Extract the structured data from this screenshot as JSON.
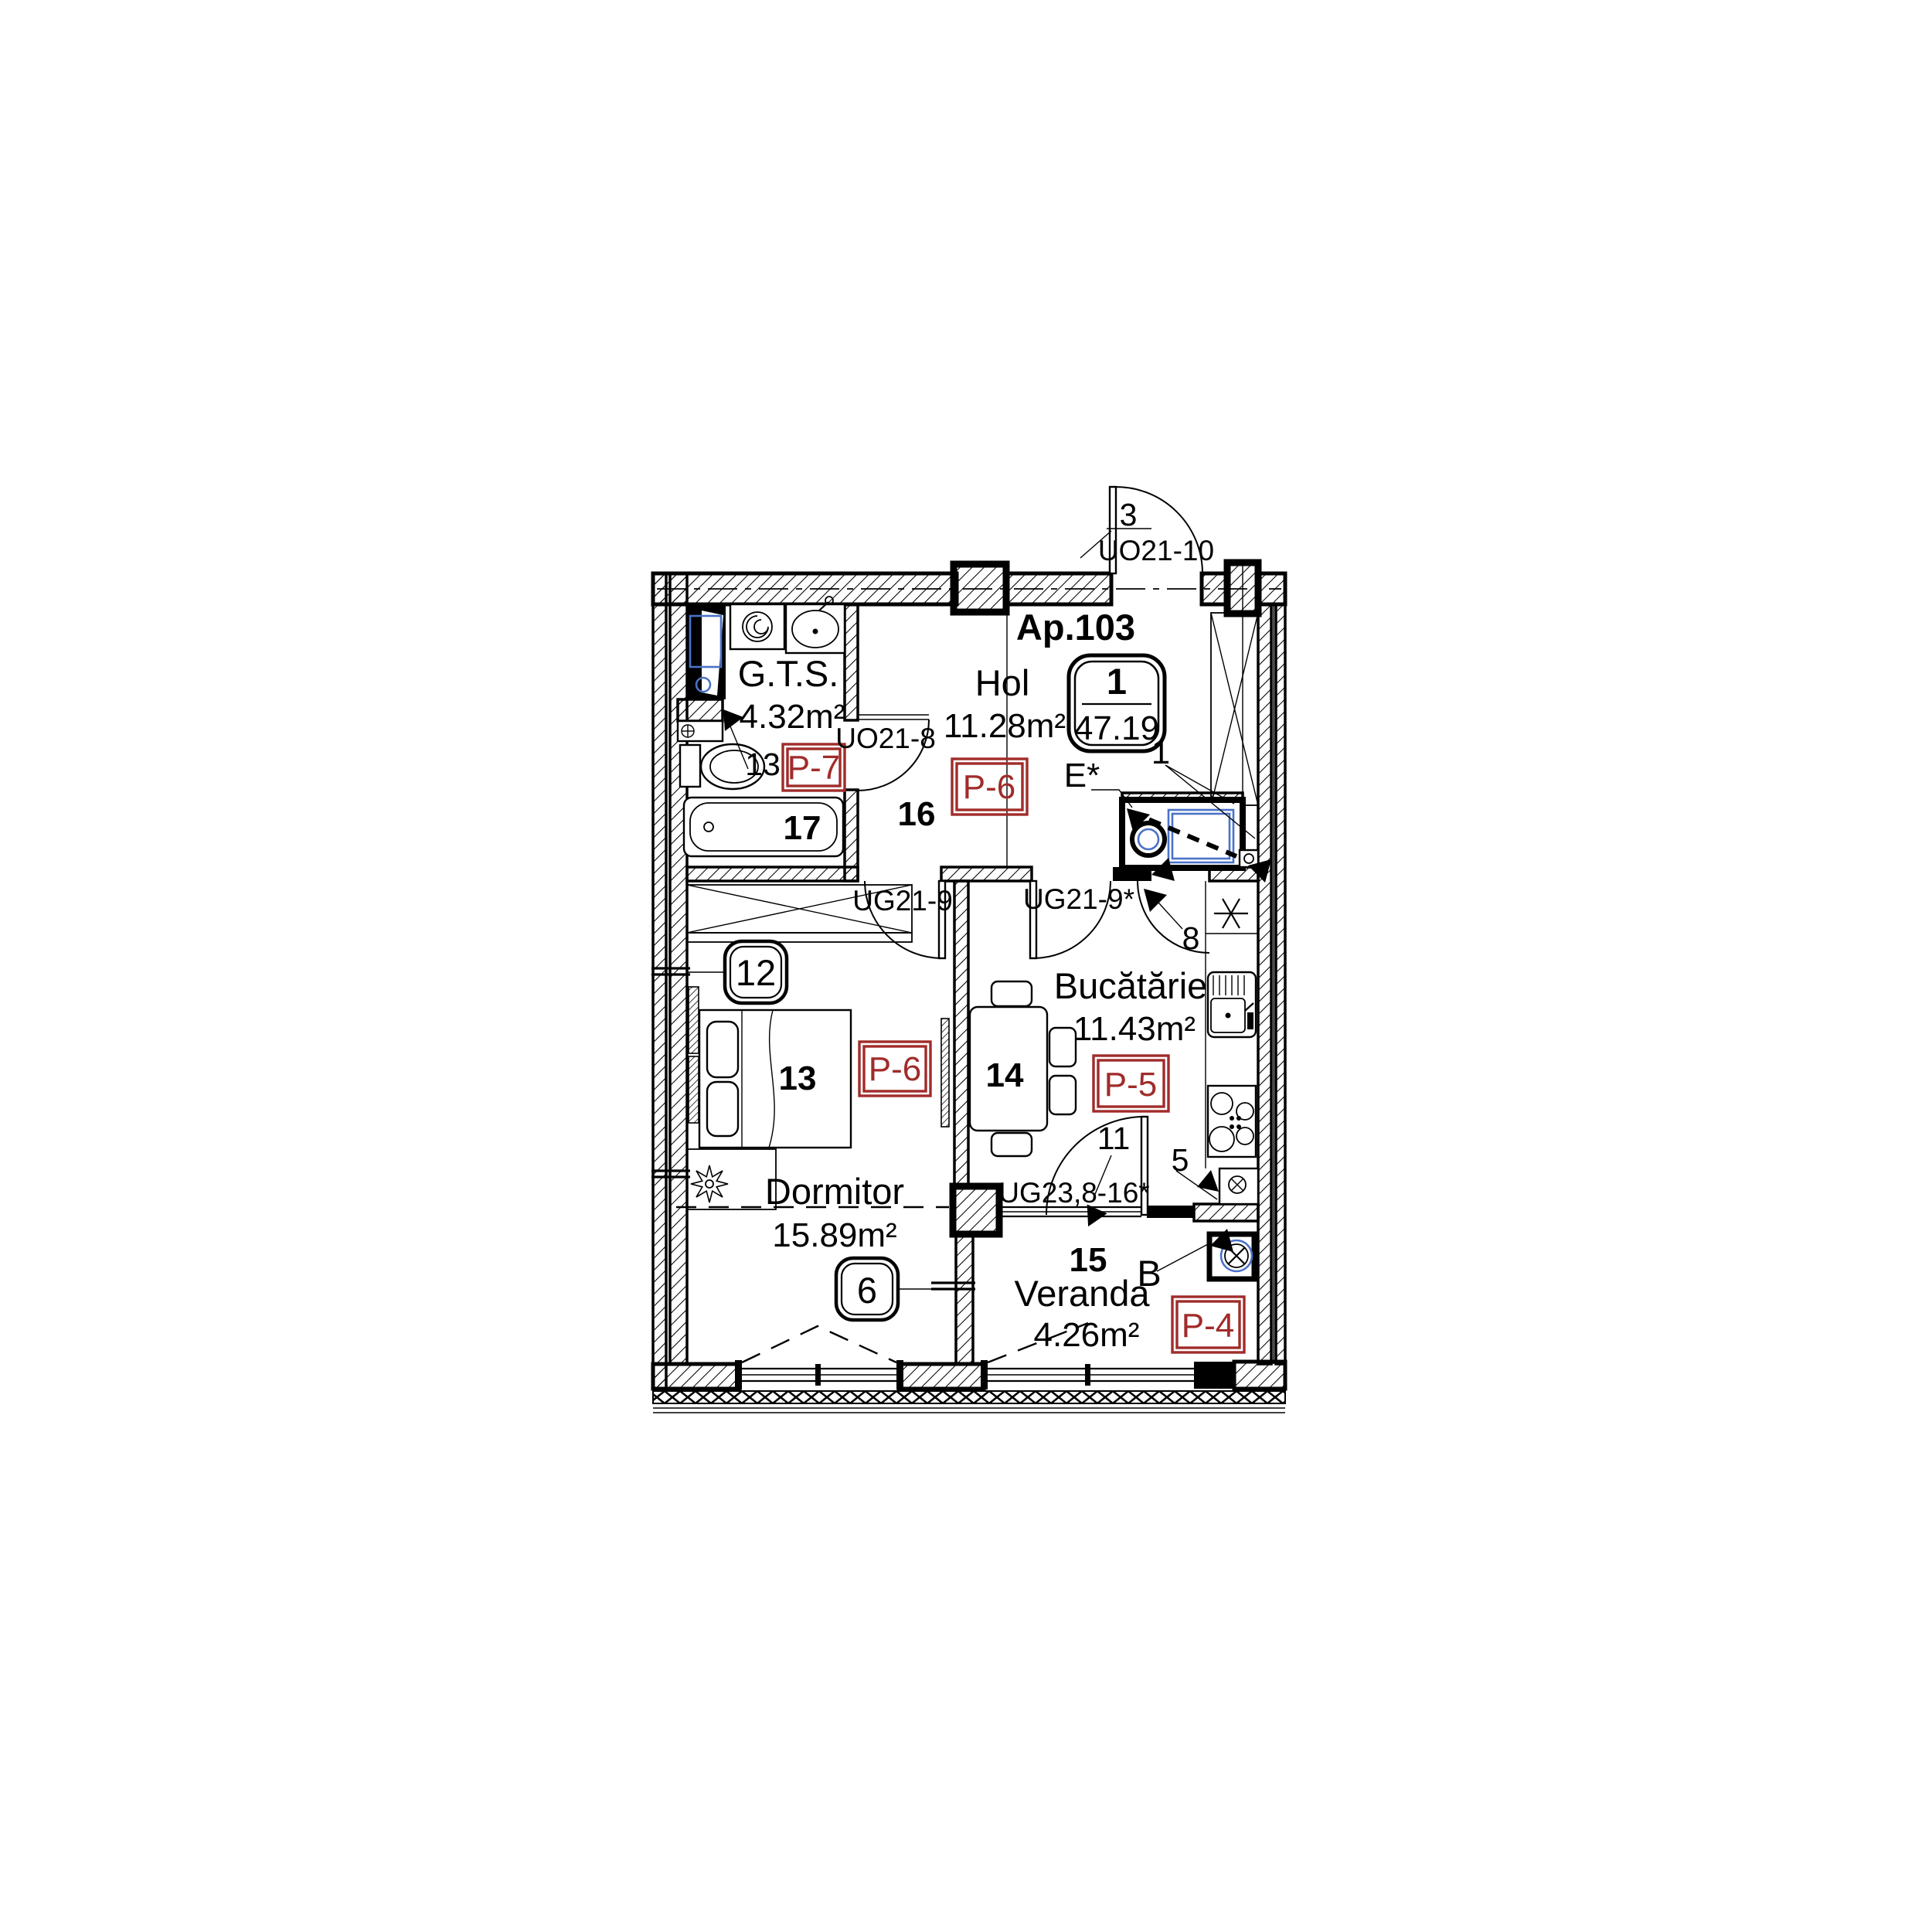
{
  "colors": {
    "red": "#A02C2A",
    "blue": "#4A72C8",
    "line": "#000000"
  },
  "apartment": {
    "name": "Ap.103",
    "unit_number": "1",
    "total_area": "47.19"
  },
  "rooms": {
    "gts": {
      "name": "G.T.S.",
      "area": "4.32m²",
      "finish_code": "P-7",
      "number": "17"
    },
    "hol": {
      "name": "Hol",
      "area": "11.28m²",
      "finish_code": "P-6",
      "number": "16"
    },
    "kitchen": {
      "name": "Bucătărie",
      "area": "11.43m²",
      "finish_code": "P-5",
      "number": "14"
    },
    "bedroom": {
      "name": "Dormitor",
      "area": "15.89m²",
      "finish_code": "P-6",
      "number": "13"
    },
    "veranda": {
      "name": "Veranda",
      "area": "4.26m²",
      "finish_code": "P-4",
      "number": "15"
    }
  },
  "openings": {
    "entrance": "UO21-10",
    "bathroom": "UO21-8",
    "bedroom": "UG21-9",
    "kitchen": "UG21-9*",
    "veranda": "UG23,8-16*"
  },
  "callouts": {
    "entrance_door_no": "3",
    "shaft": "13",
    "window_left": "12",
    "window_bottom": "6",
    "boiler_zone": "1",
    "kitchen_entry": "8",
    "kitchen_veranda_door": "11",
    "counter_end": "5",
    "drain": "B",
    "electrical": "E*"
  }
}
